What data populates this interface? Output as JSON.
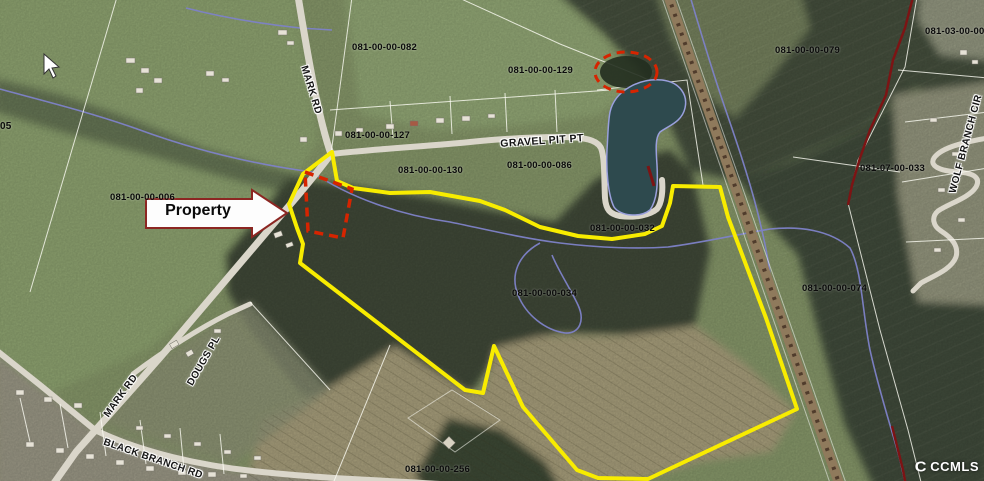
{
  "map": {
    "parcel_labels": [
      {
        "id": "parcel-082",
        "text": "081-00-00-082"
      },
      {
        "id": "parcel-129",
        "text": "081-00-00-129"
      },
      {
        "id": "parcel-127",
        "text": "081-00-00-127"
      },
      {
        "id": "parcel-130",
        "text": "081-00-00-130"
      },
      {
        "id": "parcel-086",
        "text": "081-00-00-086"
      },
      {
        "id": "parcel-032",
        "text": "081-00-00-032"
      },
      {
        "id": "parcel-079",
        "text": "081-00-00-079"
      },
      {
        "id": "parcel-003",
        "text": "081-03-00-003"
      },
      {
        "id": "parcel-033",
        "text": "081-07-00-033"
      },
      {
        "id": "parcel-074",
        "text": "081-00-00-074"
      },
      {
        "id": "parcel-034",
        "text": "081-00-00-034"
      },
      {
        "id": "parcel-256",
        "text": "081-00-00-256"
      },
      {
        "id": "parcel-006",
        "text": "081-00-00-006"
      },
      {
        "id": "parcel-edge",
        "text": "05"
      }
    ],
    "road_labels": [
      {
        "id": "mark-rd-upper",
        "text": "MARK RD"
      },
      {
        "id": "gravel-pit-pt",
        "text": "GRAVEL PIT PT"
      },
      {
        "id": "mark-rd-lower",
        "text": "MARK RD"
      },
      {
        "id": "dougs-pl",
        "text": "DOUGS PL"
      },
      {
        "id": "black-branch-rd",
        "text": "BLACK BRANCH RD"
      },
      {
        "id": "wolf-branch-cir",
        "text": "WOLF BRANCH CIR"
      }
    ],
    "callout": {
      "text": "Property"
    },
    "watermark": {
      "symbol": "C",
      "text": "CCMLS"
    },
    "colors": {
      "property_boundary": "#f8ec00",
      "highlight_outline": "#d62400",
      "water": "#2e4a4e",
      "stream": "#7e82c8",
      "road": "#dad6ca",
      "railroad": "#8f7a5c"
    }
  }
}
